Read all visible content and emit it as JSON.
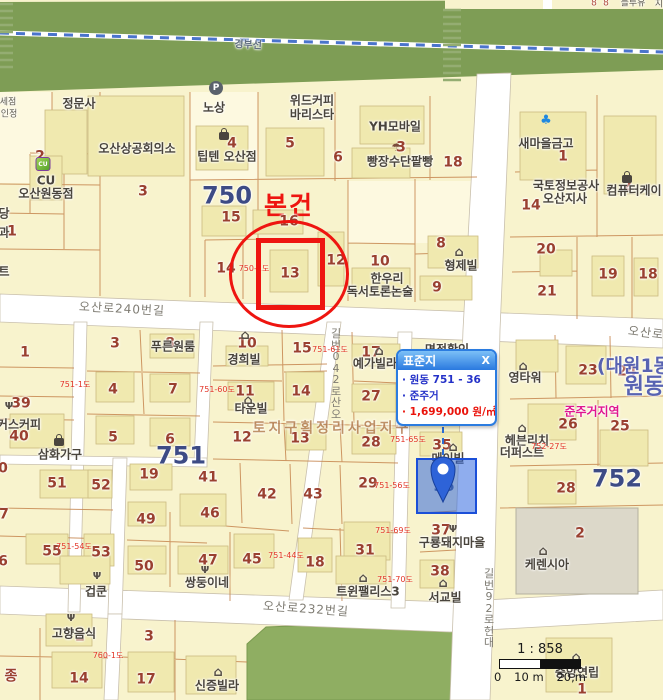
{
  "popup": {
    "title": "표준지",
    "close": "X",
    "lines": [
      "원동 751 - 36",
      "준주거",
      "1,699,000 원/㎡"
    ]
  },
  "scalebar": {
    "ratio": "1 : 858",
    "ticks": [
      "0",
      "10 m",
      "20,m"
    ]
  },
  "annotation": {
    "subject": "본건",
    "standard_parcel_number": "36"
  },
  "map": {
    "colors": {
      "accent_red": "#ee1510",
      "standard_parcel_blue": "#2e63d8",
      "popup_border_blue": "#2b7ce0",
      "parcel_yellow": "#f8f3cd",
      "building_yellow": "#f0e9af",
      "road_white": "#ffffff",
      "railway_green": "#7e9d55",
      "number_brown": "#9a4030",
      "block_number_blue": "#3d4b85",
      "zoning_magenta": "#e0168f",
      "road_parcel_red": "#e23326"
    },
    "labels": [
      {
        "t": "8",
        "x": 594,
        "y": 4,
        "c": "tr"
      },
      {
        "t": "8",
        "x": 606,
        "y": 4,
        "c": "tr"
      },
      {
        "t": "블루유",
        "x": 633,
        "y": 4,
        "c": "tp"
      },
      {
        "t": "지",
        "x": 659,
        "y": 5,
        "c": "tp"
      },
      {
        "t": "경부선",
        "x": 248,
        "y": 46,
        "c": "rail",
        "r": 3
      },
      {
        "t": "정문사",
        "x": 79,
        "y": 104,
        "c": "poi"
      },
      {
        "t": "노상",
        "x": 214,
        "y": 108,
        "c": "poi"
      },
      {
        "t": "위드커피",
        "x": 312,
        "y": 101,
        "c": "poi"
      },
      {
        "t": "바리스타",
        "x": 312,
        "y": 115,
        "c": "poi"
      },
      {
        "t": "오산상공회의소",
        "x": 137,
        "y": 149,
        "c": "poi"
      },
      {
        "t": "4",
        "x": 232,
        "y": 144,
        "c": "n"
      },
      {
        "t": "팁텐 오산점",
        "x": 227,
        "y": 157,
        "c": "poi"
      },
      {
        "t": "5",
        "x": 290,
        "y": 144,
        "c": "n"
      },
      {
        "t": "6",
        "x": 338,
        "y": 158,
        "c": "n"
      },
      {
        "t": "YH모바일",
        "x": 395,
        "y": 127,
        "c": "poi"
      },
      {
        "t": "3",
        "x": 401,
        "y": 148,
        "c": "n"
      },
      {
        "t": "빵장수단팥빵",
        "x": 400,
        "y": 162,
        "c": "poi"
      },
      {
        "t": "18",
        "x": 453,
        "y": 163,
        "c": "n"
      },
      {
        "t": "새마을금고",
        "x": 546,
        "y": 144,
        "c": "poi"
      },
      {
        "t": "1",
        "x": 563,
        "y": 157,
        "c": "n"
      },
      {
        "t": "2",
        "x": 627,
        "y": 187,
        "c": "n"
      },
      {
        "t": "컴퓨터케이",
        "x": 634,
        "y": 191,
        "c": "poi"
      },
      {
        "t": "국토정보공사",
        "x": 566,
        "y": 186,
        "c": "poi"
      },
      {
        "t": "오산지사",
        "x": 565,
        "y": 199,
        "c": "poi"
      },
      {
        "t": "14",
        "x": 531,
        "y": 206,
        "c": "n"
      },
      {
        "t": "세점",
        "x": 8,
        "y": 103,
        "c": "tp"
      },
      {
        "t": "인정",
        "x": 9,
        "y": 115,
        "c": "tp"
      },
      {
        "t": "당",
        "x": 4,
        "y": 214,
        "c": "poi"
      },
      {
        "t": "과",
        "x": 4,
        "y": 233,
        "c": "poi"
      },
      {
        "t": "1",
        "x": 12,
        "y": 232,
        "c": "n"
      },
      {
        "t": "트",
        "x": 4,
        "y": 272,
        "c": "poi"
      },
      {
        "t": "2",
        "x": 40,
        "y": 157,
        "c": "n"
      },
      {
        "t": "CU",
        "x": 46,
        "y": 181,
        "c": "poi"
      },
      {
        "t": "오산원동점",
        "x": 46,
        "y": 194,
        "c": "poi"
      },
      {
        "t": "3",
        "x": 143,
        "y": 192,
        "c": "n"
      },
      {
        "t": "750",
        "x": 227,
        "y": 196,
        "c": "bn"
      },
      {
        "t": "15",
        "x": 231,
        "y": 218,
        "c": "n"
      },
      {
        "t": "본건",
        "x": 289,
        "y": 206,
        "c": "anno"
      },
      {
        "t": "16",
        "x": 289,
        "y": 222,
        "c": "n"
      },
      {
        "t": "14",
        "x": 226,
        "y": 269,
        "c": "n"
      },
      {
        "t": "750-1도",
        "x": 254,
        "y": 269,
        "c": "rp"
      },
      {
        "t": "13",
        "x": 290,
        "y": 274,
        "c": "n"
      },
      {
        "t": "12",
        "x": 336,
        "y": 261,
        "c": "n"
      },
      {
        "t": "10",
        "x": 380,
        "y": 262,
        "c": "n"
      },
      {
        "t": "한우리",
        "x": 387,
        "y": 279,
        "c": "poi"
      },
      {
        "t": "독서토론논술",
        "x": 380,
        "y": 292,
        "c": "poi"
      },
      {
        "t": "8",
        "x": 441,
        "y": 244,
        "c": "n"
      },
      {
        "t": "형제빌",
        "x": 461,
        "y": 266,
        "c": "poi"
      },
      {
        "t": "9",
        "x": 437,
        "y": 288,
        "c": "n"
      },
      {
        "t": "20",
        "x": 546,
        "y": 250,
        "c": "n"
      },
      {
        "t": "21",
        "x": 547,
        "y": 292,
        "c": "n"
      },
      {
        "t": "19",
        "x": 608,
        "y": 275,
        "c": "n"
      },
      {
        "t": "18",
        "x": 648,
        "y": 275,
        "c": "n"
      },
      {
        "t": "오산로240번길",
        "x": 122,
        "y": 309,
        "c": "road",
        "r": 3
      },
      {
        "t": "오산로",
        "x": 646,
        "y": 333,
        "c": "road",
        "r": 7
      },
      {
        "t": "오산로240번길",
        "x": 336,
        "y": 374,
        "c": "roadv"
      },
      {
        "t": "오산로232번길",
        "x": 306,
        "y": 609,
        "c": "road",
        "r": 4
      },
      {
        "t": "대헌로29번길",
        "x": 489,
        "y": 608,
        "c": "roadv"
      },
      {
        "t": "1",
        "x": 25,
        "y": 353,
        "c": "n"
      },
      {
        "t": "3",
        "x": 115,
        "y": 344,
        "c": "n"
      },
      {
        "t": "8",
        "x": 170,
        "y": 344,
        "c": "n"
      },
      {
        "t": "푸른원룸",
        "x": 173,
        "y": 347,
        "c": "poi"
      },
      {
        "t": "4",
        "x": 113,
        "y": 390,
        "c": "n"
      },
      {
        "t": "7",
        "x": 173,
        "y": 390,
        "c": "n"
      },
      {
        "t": "751-1도",
        "x": 75,
        "y": 385,
        "c": "rp"
      },
      {
        "t": "751-60도",
        "x": 217,
        "y": 390,
        "c": "rp"
      },
      {
        "t": "39",
        "x": 21,
        "y": 404,
        "c": "n"
      },
      {
        "t": "커스커피",
        "x": 19,
        "y": 425,
        "c": "poi"
      },
      {
        "t": "40",
        "x": 19,
        "y": 437,
        "c": "n"
      },
      {
        "t": "삼화가구",
        "x": 60,
        "y": 455,
        "c": "poi"
      },
      {
        "t": "5",
        "x": 113,
        "y": 438,
        "c": "n"
      },
      {
        "t": "6",
        "x": 170,
        "y": 440,
        "c": "n"
      },
      {
        "t": "10",
        "x": 247,
        "y": 344,
        "c": "n"
      },
      {
        "t": "경희빌",
        "x": 244,
        "y": 360,
        "c": "poi"
      },
      {
        "t": "15",
        "x": 302,
        "y": 349,
        "c": "n"
      },
      {
        "t": "751-61도",
        "x": 330,
        "y": 350,
        "c": "rp"
      },
      {
        "t": "17",
        "x": 371,
        "y": 353,
        "c": "n"
      },
      {
        "t": "예가빌라",
        "x": 375,
        "y": 364,
        "c": "poi"
      },
      {
        "t": "11",
        "x": 245,
        "y": 392,
        "c": "n"
      },
      {
        "t": "타운빌",
        "x": 251,
        "y": 409,
        "c": "poi"
      },
      {
        "t": "14",
        "x": 301,
        "y": 392,
        "c": "n"
      },
      {
        "t": "27",
        "x": 371,
        "y": 397,
        "c": "n"
      },
      {
        "t": "12",
        "x": 242,
        "y": 438,
        "c": "n"
      },
      {
        "t": "13",
        "x": 300,
        "y": 439,
        "c": "n"
      },
      {
        "t": "28",
        "x": 371,
        "y": 443,
        "c": "n"
      },
      {
        "t": "토지구획정리사업지구",
        "x": 332,
        "y": 429,
        "c": "wm"
      },
      {
        "t": "751",
        "x": 181,
        "y": 456,
        "c": "bn"
      },
      {
        "t": "41",
        "x": 208,
        "y": 478,
        "c": "n"
      },
      {
        "t": "42",
        "x": 267,
        "y": 495,
        "c": "n"
      },
      {
        "t": "43",
        "x": 313,
        "y": 495,
        "c": "n"
      },
      {
        "t": "29",
        "x": 368,
        "y": 484,
        "c": "n"
      },
      {
        "t": "751-56도",
        "x": 392,
        "y": 486,
        "c": "rp"
      },
      {
        "t": "51",
        "x": 57,
        "y": 484,
        "c": "n"
      },
      {
        "t": "52",
        "x": 101,
        "y": 486,
        "c": "n"
      },
      {
        "t": "19",
        "x": 149,
        "y": 475,
        "c": "n"
      },
      {
        "t": "0",
        "x": 3,
        "y": 469,
        "c": "n"
      },
      {
        "t": "46",
        "x": 210,
        "y": 514,
        "c": "n"
      },
      {
        "t": "49",
        "x": 146,
        "y": 520,
        "c": "n"
      },
      {
        "t": "7",
        "x": 4,
        "y": 515,
        "c": "n"
      },
      {
        "t": "6",
        "x": 3,
        "y": 562,
        "c": "n"
      },
      {
        "t": "55",
        "x": 52,
        "y": 552,
        "c": "n"
      },
      {
        "t": "751-54도",
        "x": 74,
        "y": 547,
        "c": "rp"
      },
      {
        "t": "53",
        "x": 101,
        "y": 553,
        "c": "n"
      },
      {
        "t": "50",
        "x": 144,
        "y": 567,
        "c": "n"
      },
      {
        "t": "47",
        "x": 208,
        "y": 561,
        "c": "n"
      },
      {
        "t": "쌍둥이네",
        "x": 207,
        "y": 583,
        "c": "poi"
      },
      {
        "t": "겁쿤",
        "x": 96,
        "y": 592,
        "c": "poi"
      },
      {
        "t": "45",
        "x": 252,
        "y": 560,
        "c": "n"
      },
      {
        "t": "751-44도",
        "x": 286,
        "y": 556,
        "c": "rp"
      },
      {
        "t": "18",
        "x": 315,
        "y": 563,
        "c": "n"
      },
      {
        "t": "31",
        "x": 365,
        "y": 551,
        "c": "n"
      },
      {
        "t": "751-69도",
        "x": 393,
        "y": 531,
        "c": "rp"
      },
      {
        "t": "751-70도",
        "x": 395,
        "y": 580,
        "c": "rp"
      },
      {
        "t": "트윈팰리스3",
        "x": 368,
        "y": 592,
        "c": "poi"
      },
      {
        "t": "37",
        "x": 441,
        "y": 531,
        "c": "n"
      },
      {
        "t": "구룡돼지마을",
        "x": 452,
        "y": 543,
        "c": "poi"
      },
      {
        "t": "38",
        "x": 440,
        "y": 572,
        "c": "n"
      },
      {
        "t": "서교빌",
        "x": 445,
        "y": 598,
        "c": "poi"
      },
      {
        "t": "2",
        "x": 80,
        "y": 637,
        "c": "n"
      },
      {
        "t": "고향음식",
        "x": 74,
        "y": 634,
        "c": "poi"
      },
      {
        "t": "3",
        "x": 149,
        "y": 637,
        "c": "n"
      },
      {
        "t": "760-1도",
        "x": 108,
        "y": 656,
        "c": "rp"
      },
      {
        "t": "14",
        "x": 79,
        "y": 679,
        "c": "n"
      },
      {
        "t": "17",
        "x": 146,
        "y": 680,
        "c": "n"
      },
      {
        "t": "종",
        "x": 11,
        "y": 677,
        "c": "n"
      },
      {
        "t": "신증빌라",
        "x": 217,
        "y": 686,
        "c": "poi"
      },
      {
        "t": "영타워",
        "x": 525,
        "y": 378,
        "c": "poi"
      },
      {
        "t": "23",
        "x": 588,
        "y": 371,
        "c": "n"
      },
      {
        "t": "24",
        "x": 627,
        "y": 372,
        "c": "n"
      },
      {
        "t": "(대원1동",
        "x": 634,
        "y": 367,
        "c": "adm"
      },
      {
        "t": "원동",
        "x": 644,
        "y": 387,
        "c": "adm2"
      },
      {
        "t": "준주거지역",
        "x": 592,
        "y": 412,
        "c": "zone"
      },
      {
        "t": "26",
        "x": 568,
        "y": 425,
        "c": "n"
      },
      {
        "t": "25",
        "x": 620,
        "y": 427,
        "c": "n"
      },
      {
        "t": "헤븐리치",
        "x": 527,
        "y": 441,
        "c": "poi"
      },
      {
        "t": "더퍼스트",
        "x": 522,
        "y": 453,
        "c": "poi"
      },
      {
        "t": "752-27도",
        "x": 549,
        "y": 447,
        "c": "rp"
      },
      {
        "t": "28",
        "x": 566,
        "y": 489,
        "c": "n"
      },
      {
        "t": "752",
        "x": 617,
        "y": 479,
        "c": "bn"
      },
      {
        "t": "2",
        "x": 580,
        "y": 534,
        "c": "n"
      },
      {
        "t": "케렌시아",
        "x": 547,
        "y": 565,
        "c": "poi"
      },
      {
        "t": "중앙연립",
        "x": 577,
        "y": 673,
        "c": "poi"
      },
      {
        "t": "1",
        "x": 582,
        "y": 690,
        "c": "n"
      },
      {
        "t": "35",
        "x": 442,
        "y": 446,
        "c": "n"
      },
      {
        "t": "751-65도",
        "x": 408,
        "y": 440,
        "c": "rp"
      },
      {
        "t": "메이빌",
        "x": 448,
        "y": 459,
        "c": "poi"
      },
      {
        "t": "면적확인",
        "x": 447,
        "y": 350,
        "c": "poi"
      },
      {
        "t": "36",
        "x": 444,
        "y": 487,
        "c": "pn"
      }
    ],
    "icons": [
      {
        "type": "parking",
        "x": 216,
        "y": 88
      },
      {
        "type": "bag",
        "x": 224,
        "y": 136
      },
      {
        "type": "umbrella",
        "x": 396,
        "y": 147
      },
      {
        "type": "saemaeul",
        "x": 546,
        "y": 120
      },
      {
        "type": "bag",
        "x": 627,
        "y": 179
      },
      {
        "type": "cu",
        "x": 43,
        "y": 164
      },
      {
        "type": "bag",
        "x": 59,
        "y": 442
      },
      {
        "type": "house",
        "x": 459,
        "y": 252
      },
      {
        "type": "house",
        "x": 245,
        "y": 335
      },
      {
        "type": "house",
        "x": 379,
        "y": 351
      },
      {
        "type": "house",
        "x": 248,
        "y": 400
      },
      {
        "type": "house",
        "x": 523,
        "y": 366
      },
      {
        "type": "house",
        "x": 522,
        "y": 428
      },
      {
        "type": "house",
        "x": 543,
        "y": 551
      },
      {
        "type": "house",
        "x": 363,
        "y": 578
      },
      {
        "type": "house",
        "x": 443,
        "y": 583
      },
      {
        "type": "house",
        "x": 218,
        "y": 672
      },
      {
        "type": "house",
        "x": 576,
        "y": 657
      },
      {
        "type": "house",
        "x": 453,
        "y": 447
      },
      {
        "type": "fork",
        "x": 9,
        "y": 406
      },
      {
        "type": "fork",
        "x": 205,
        "y": 570
      },
      {
        "type": "fork",
        "x": 97,
        "y": 576
      },
      {
        "type": "fork",
        "x": 453,
        "y": 529
      },
      {
        "type": "fork",
        "x": 71,
        "y": 618
      }
    ]
  }
}
